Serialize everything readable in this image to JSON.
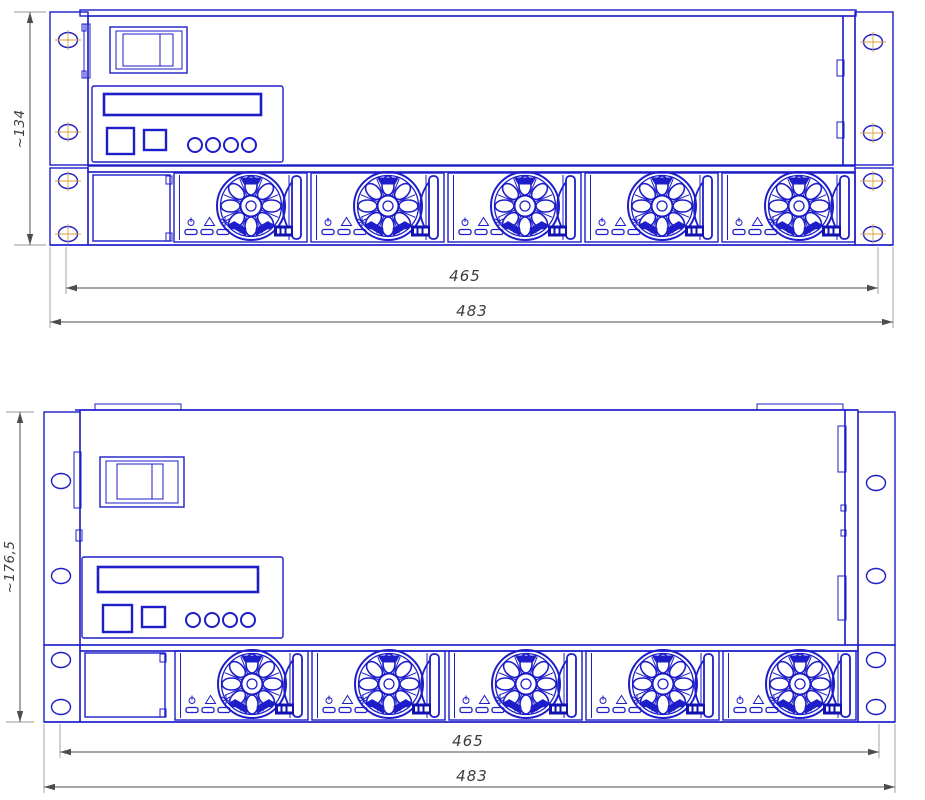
{
  "colors": {
    "line": "#1d1dc9",
    "badge_fill": "#1212b0",
    "dim_line": "#4d4d4d",
    "extension_line": "#9a9a9a",
    "dim_text": "#3d3d3d",
    "centerline": "#d9a23f",
    "background": "#ffffff"
  },
  "views": [
    {
      "name": "front-view-upper",
      "height_dim": "~134",
      "inner_width_dim": "465",
      "outer_width_dim": "483",
      "fan_count": 5
    },
    {
      "name": "front-view-lower",
      "height_dim": "~176,5",
      "inner_width_dim": "465",
      "outer_width_dim": "483",
      "fan_count": 5
    }
  ],
  "fan_rows": [
    {
      "view": 0,
      "x0": 172,
      "y0": 172,
      "spacing": 137
    },
    {
      "view": 1,
      "view_name": "front-view-lower",
      "x0": 173,
      "y0": 650,
      "spacing": 137
    }
  ],
  "fan_module": {
    "led_icons": [
      "power-icon",
      "alarm-icon",
      "fan-icon"
    ],
    "led_count": 3,
    "has_handle": true,
    "has_brand_badge": true
  },
  "control_panel": {
    "display": "lcd-display",
    "square_button_count": 2,
    "round_button_count": 4
  },
  "components": {
    "breaker_switch": "rocker-breaker",
    "mounting_holes_per_ear": 4,
    "blank_filler_panel": true
  }
}
